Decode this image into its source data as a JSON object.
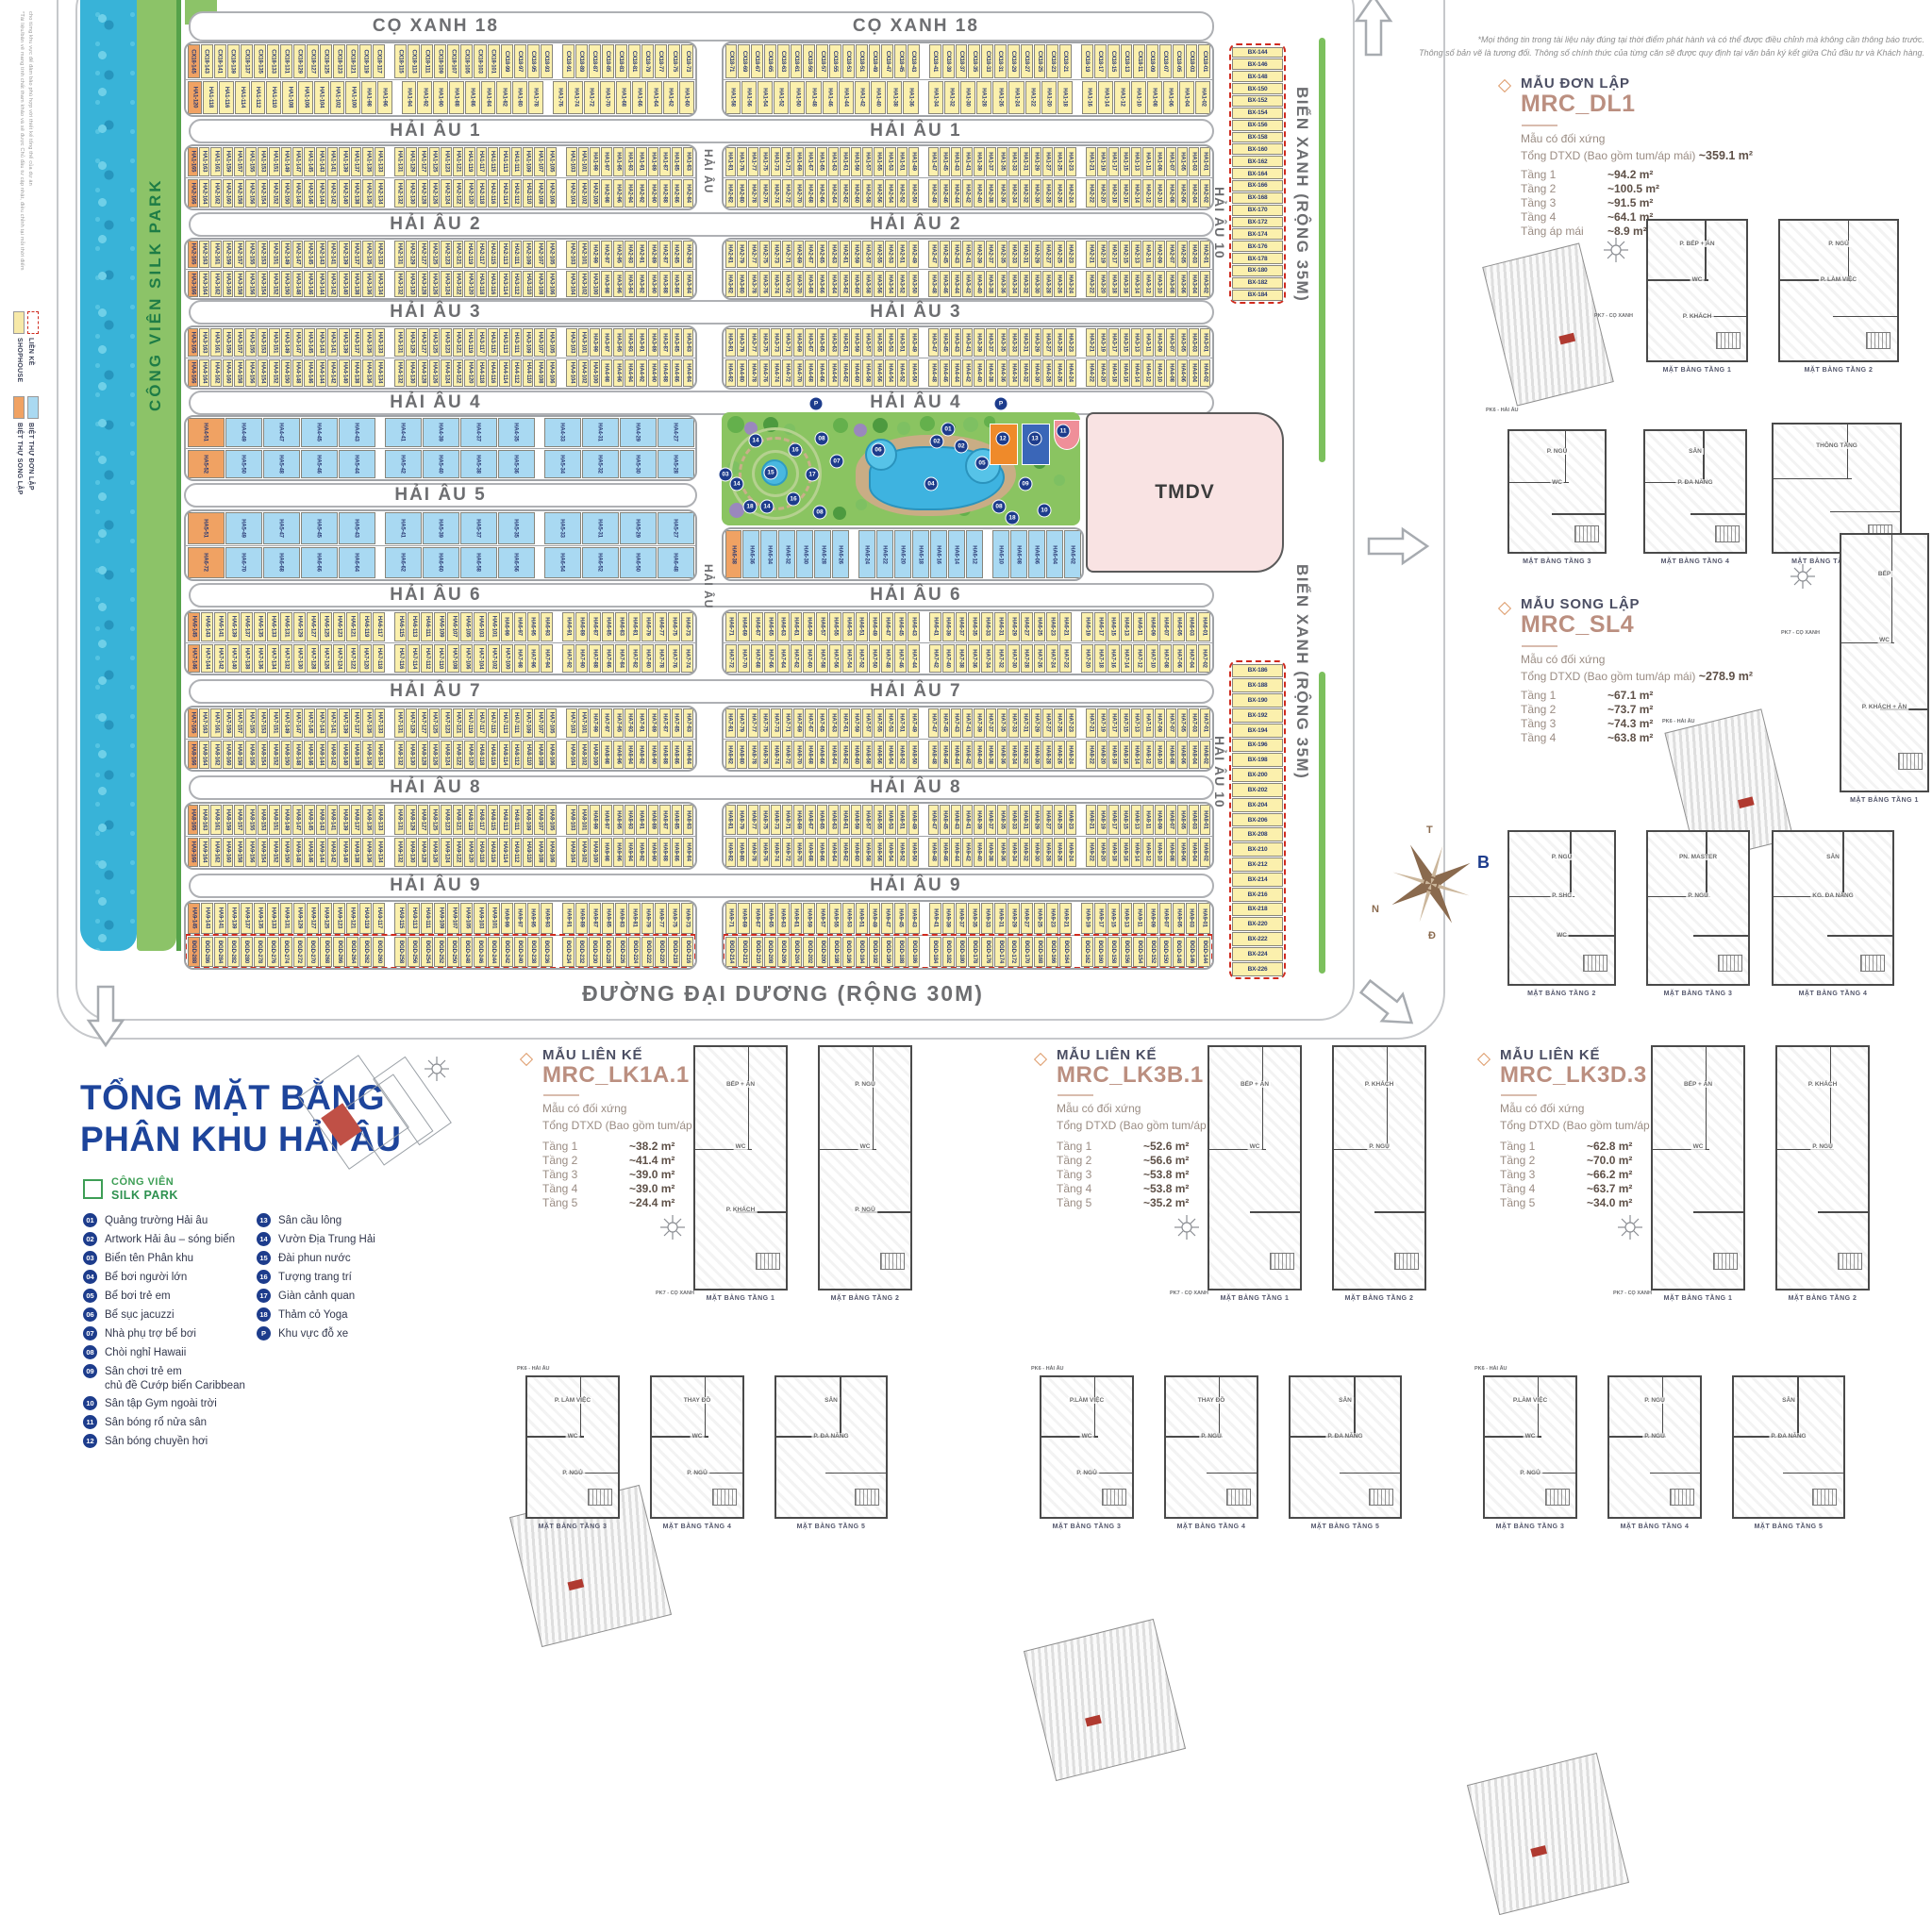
{
  "disclaimers": {
    "top_right_1": "*Mọi thông tin trong tài liệu này đúng tại thời điểm phát hành và có thể được điều chỉnh mà không cần thông báo trước.",
    "top_right_2": "Thông số bản vẽ là tương đối. Thông số chính thức của từng căn sẽ được quy định tại văn bản ký kết giữa Chủ đầu tư và Khách hàng.",
    "left_1": "*Tài liệu/bản vẽ mang tính chất tham khảo và sẽ được Chủ đầu tư cập nhật, điều chỉnh tại mỗi thời điểm",
    "left_2": "cho từng khu vực để đảm bảo phù hợp với thiết kế tổng thể của dự án"
  },
  "park_strip": {
    "line1": "CÔNG VIÊN",
    "line2": "SILK PARK"
  },
  "roads": {
    "mid_vertical": "HẢI ÂU",
    "east_vertical": "HẢI ÂU 10",
    "bien_xanh": "BIỂN XANH (RỘNG 35M)",
    "dai_duong": "ĐƯỜNG ĐẠI DƯƠNG (RỘNG 30M)"
  },
  "tmdv_label": "TMDV",
  "bands": [
    {
      "title": "CỌ XANH 18",
      "top": {
        "prefix": "CX18",
        "from": 145,
        "to": 1,
        "of": true
      },
      "bottom": {
        "prefix": "HA1",
        "from": 120,
        "to": 2,
        "of": true
      }
    },
    {
      "title": "HẢI ÂU 1",
      "top": {
        "prefix": "HA1",
        "from": 165,
        "to": 1,
        "of": true
      },
      "bottom": {
        "prefix": "HA2",
        "from": 166,
        "to": 2,
        "of": true
      }
    },
    {
      "title": "HẢI ÂU 2",
      "top": {
        "prefix": "HA2",
        "from": 165,
        "to": 1,
        "of": true
      },
      "bottom": {
        "prefix": "HA3",
        "from": 166,
        "to": 2,
        "of": true
      }
    },
    {
      "title": "HẢI ÂU 3",
      "top": {
        "prefix": "HA3",
        "from": 165,
        "to": 1,
        "of": true
      },
      "bottom": {
        "prefix": "HA4",
        "from": 166,
        "to": 2,
        "of": true
      }
    },
    {
      "title": "HẢI ÂU 4"
    },
    {
      "title": "HẢI ÂU 6",
      "top": {
        "prefix": "HA6",
        "from": 145,
        "to": 1,
        "of": true
      },
      "bottom": {
        "prefix": "HA7",
        "from": 146,
        "to": 2,
        "of": true
      }
    },
    {
      "title": "HẢI ÂU 7",
      "top": {
        "prefix": "HA7",
        "from": 165,
        "to": 1,
        "of": true
      },
      "bottom": {
        "prefix": "HA8",
        "from": 166,
        "to": 2,
        "of": true
      }
    },
    {
      "title": "HẢI ÂU 8",
      "top": {
        "prefix": "HA8",
        "from": 165,
        "to": 1,
        "of": true
      },
      "bottom": {
        "prefix": "HA9",
        "from": 166,
        "to": 2,
        "of": true
      }
    },
    {
      "title": "HẢI ÂU 9",
      "top": {
        "prefix": "HA9",
        "from": 145,
        "to": 1,
        "of": true
      },
      "bottom": {
        "prefix": "ĐGD",
        "from": 288,
        "to": 144,
        "pad": 3,
        "of": true,
        "dash": true
      }
    }
  ],
  "blue_zone": {
    "title": "HẢI ÂU 5",
    "strip1": {
      "top": {
        "prefix": "HA4",
        "from": 51,
        "to": 27,
        "of": true,
        "blue": true
      },
      "bottom": {
        "prefix": "HA5",
        "from": 52,
        "to": 28,
        "of": true,
        "blue": true
      }
    },
    "strip2": {
      "top": {
        "prefix": "HA5",
        "from": 51,
        "to": 27,
        "of": true,
        "blue": true
      },
      "bottom": {
        "prefix": "HA6",
        "from": 72,
        "to": 48,
        "of": true,
        "blue": true
      }
    },
    "park_row": {
      "prefix": "HA6",
      "from": 38,
      "to": 2,
      "of": true,
      "blue": true
    }
  },
  "bx": {
    "top": {
      "prefix": "BX",
      "from": 144,
      "to": 184,
      "pad": 3
    },
    "bottom": {
      "prefix": "BX",
      "from": 186,
      "to": 226,
      "pad": 3
    }
  },
  "park_markers": [
    "P",
    "P",
    "01",
    "02",
    "02",
    "03",
    "04",
    "05",
    "06",
    "07",
    "08",
    "08",
    "08",
    "09",
    "10",
    "11",
    "12",
    "13",
    "14",
    "14",
    "14",
    "15",
    "16",
    "16",
    "17",
    "18",
    "18"
  ],
  "side_legend": {
    "shophouse": "SHOPHOUSE",
    "lienke": "LIỀN KỀ",
    "songlap": "BIỆT THỰ SONG LẬP",
    "donlap": "BIỆT THỰ ĐƠN LẬP"
  },
  "title_block": {
    "line1": "TỔNG MẶT BẰNG",
    "line2": "PHÂN KHU HẢI ÂU"
  },
  "legend": {
    "park_line1": "CÔNG VIÊN",
    "park_line2": "SILK PARK",
    "col1": [
      {
        "num": "01",
        "label": "Quảng trường Hải âu"
      },
      {
        "num": "02",
        "label": "Artwork Hải âu – sóng biển"
      },
      {
        "num": "03",
        "label": "Biển tên Phân khu"
      },
      {
        "num": "04",
        "label": "Bể bơi người lớn"
      },
      {
        "num": "05",
        "label": "Bể bơi trẻ em"
      },
      {
        "num": "06",
        "label": "Bể sục jacuzzi"
      },
      {
        "num": "07",
        "label": "Nhà phụ trợ bể bơi"
      },
      {
        "num": "08",
        "label": "Chòi nghỉ Hawaii"
      },
      {
        "num": "09",
        "label": "Sân chơi trẻ em",
        "label2": "chủ đề Cướp biển Caribbean"
      },
      {
        "num": "10",
        "label": "Sân tập Gym ngoài trời"
      },
      {
        "num": "11",
        "label": "Sân bóng rổ nửa sân"
      },
      {
        "num": "12",
        "label": "Sân bóng chuyền hơi"
      }
    ],
    "col2": [
      {
        "num": "13",
        "label": "Sân cầu lông"
      },
      {
        "num": "14",
        "label": "Vườn Địa Trung Hải"
      },
      {
        "num": "15",
        "label": "Đài phun nước"
      },
      {
        "num": "16",
        "label": "Tượng trang trí"
      },
      {
        "num": "17",
        "label": "Giàn cảnh quan"
      },
      {
        "num": "18",
        "label": "Thảm cỏ Yoga"
      },
      {
        "num": "P",
        "label": "Khu vực đỗ xe"
      }
    ]
  },
  "compass": {
    "n": "B",
    "e": "Đ",
    "s": "N",
    "w": "T"
  },
  "locator": {
    "pk7": "PK7 - CỌ XANH",
    "pk6": "PK6 - HẢI ÂU"
  },
  "models": [
    {
      "category": "MẪU ĐƠN LẬP",
      "code": "MRC_DL1",
      "sym": "Mẫu có đối xứng",
      "total_label": "Tổng DTXD (Bao gồm tum/áp mái)",
      "total_value": "~359.1 m²",
      "floors": [
        [
          "Tầng 1",
          "~94.2 m²"
        ],
        [
          "Tầng 2",
          "~100.5 m²"
        ],
        [
          "Tầng 3",
          "~91.5 m²"
        ],
        [
          "Tầng 4",
          "~64.1 m²"
        ],
        [
          "Tầng áp mái",
          "~8.9 m²"
        ]
      ],
      "plans": [
        {
          "cap": "MẶT BẰNG TẦNG 1",
          "rooms": [
            "P. BẾP + ĂN",
            "WC",
            "P. KHÁCH"
          ]
        },
        {
          "cap": "MẶT BẰNG TẦNG 2",
          "rooms": [
            "P. NGỦ",
            "P. LÀM VIỆC"
          ]
        },
        {
          "cap": "MẶT BẰNG TẦNG 3",
          "rooms": [
            "P. NGỦ",
            "WC"
          ]
        },
        {
          "cap": "MẶT BẰNG TẦNG 4",
          "rooms": [
            "SÂN",
            "P. ĐA NĂNG"
          ]
        },
        {
          "cap": "MẶT BẰNG TẦNG ÁP MÁI",
          "rooms": [
            "THÔNG TẦNG"
          ]
        }
      ]
    },
    {
      "category": "MẪU SONG LẬP",
      "code": "MRC_SL4",
      "sym": "Mẫu có đối xứng",
      "total_label": "Tổng DTXD (Bao gồm tum/áp mái)",
      "total_value": "~278.9 m²",
      "floors": [
        [
          "Tầng 1",
          "~67.1 m²"
        ],
        [
          "Tầng 2",
          "~73.7 m²"
        ],
        [
          "Tầng 3",
          "~74.3 m²"
        ],
        [
          "Tầng 4",
          "~63.8 m²"
        ]
      ],
      "plans": [
        {
          "cap": "MẶT BẰNG TẦNG 1",
          "rooms": [
            "BẾP",
            "WC",
            "P. KHÁCH + ĂN"
          ]
        },
        {
          "cap": "MẶT BẰNG TẦNG 2",
          "rooms": [
            "P. NGỦ",
            "P. SHC",
            "WC"
          ]
        },
        {
          "cap": "MẶT BẰNG TẦNG 3",
          "rooms": [
            "PN. MASTER",
            "P. NGỦ"
          ]
        },
        {
          "cap": "MẶT BẰNG TẦNG 4",
          "rooms": [
            "SÂN",
            "KG. ĐA NĂNG"
          ]
        }
      ]
    },
    {
      "category": "MẪU LIÊN KẾ",
      "code": "MRC_LK1A.1",
      "sym": "Mẫu có đối xứng",
      "total_label": "Tổng DTXD (Bao gồm tum/áp mái)",
      "total_value": "~182.0 m²",
      "floors": [
        [
          "Tầng 1",
          "~38.2 m²"
        ],
        [
          "Tầng 2",
          "~41.4 m²"
        ],
        [
          "Tầng 3",
          "~39.0 m²"
        ],
        [
          "Tầng 4",
          "~39.0 m²"
        ],
        [
          "Tầng 5",
          "~24.4 m²"
        ]
      ],
      "plans": [
        {
          "cap": "MẶT BẰNG TẦNG 1",
          "rooms": [
            "BẾP + ĂN",
            "WC",
            "P. KHÁCH"
          ]
        },
        {
          "cap": "MẶT BẰNG TẦNG 2",
          "rooms": [
            "P. NGỦ",
            "WC",
            "P. NGỦ"
          ]
        },
        {
          "cap": "MẶT BẰNG TẦNG 3",
          "rooms": [
            "P. LÀM VIỆC",
            "WC",
            "P. NGỦ"
          ]
        },
        {
          "cap": "MẶT BẰNG TẦNG 4",
          "rooms": [
            "THAY ĐỒ",
            "WC",
            "P. NGỦ"
          ]
        },
        {
          "cap": "MẶT BẰNG TẦNG 5",
          "rooms": [
            "SÂN",
            "P. ĐA NĂNG"
          ]
        }
      ]
    },
    {
      "category": "MẪU LIÊN KẾ",
      "code": "MRC_LK3B.1",
      "sym": "Mẫu có đối xứng",
      "total_label": "Tổng DTXD (Bao gồm tum/áp mái)",
      "total_value": "~252.0 m²",
      "floors": [
        [
          "Tầng 1",
          "~52.6 m²"
        ],
        [
          "Tầng 2",
          "~56.6 m²"
        ],
        [
          "Tầng 3",
          "~53.8 m²"
        ],
        [
          "Tầng 4",
          "~53.8 m²"
        ],
        [
          "Tầng 5",
          "~35.2 m²"
        ]
      ],
      "plans": [
        {
          "cap": "MẶT BẰNG TẦNG 1",
          "rooms": [
            "BẾP + ĂN",
            "WC"
          ]
        },
        {
          "cap": "MẶT BẰNG TẦNG 2",
          "rooms": [
            "P. KHÁCH",
            "P. NGỦ"
          ]
        },
        {
          "cap": "MẶT BẰNG TẦNG 3",
          "rooms": [
            "P.LÀM VIỆC",
            "WC",
            "P. NGỦ"
          ]
        },
        {
          "cap": "MẶT BẰNG TẦNG 4",
          "rooms": [
            "THAY ĐỒ",
            "P. NGỦ"
          ]
        },
        {
          "cap": "MẶT BẰNG TẦNG 5",
          "rooms": [
            "SÂN",
            "P. ĐA NĂNG"
          ]
        }
      ]
    },
    {
      "category": "MẪU LIÊN KẾ",
      "code": "MRC_LK3D.3",
      "sym": "Mẫu có đối xứng",
      "total_label": "Tổng DTXD (Bao gồm tum/áp mái)",
      "total_value": "~296.7 m²",
      "floors": [
        [
          "Tầng 1",
          "~62.8 m²"
        ],
        [
          "Tầng 2",
          "~70.0 m²"
        ],
        [
          "Tầng 3",
          "~66.2 m²"
        ],
        [
          "Tầng 4",
          "~63.7 m²"
        ],
        [
          "Tầng 5",
          "~34.0 m²"
        ]
      ],
      "plans": [
        {
          "cap": "MẶT BẰNG TẦNG 1",
          "rooms": [
            "BẾP + ĂN",
            "WC"
          ]
        },
        {
          "cap": "MẶT BẰNG TẦNG 2",
          "rooms": [
            "P. KHÁCH",
            "P. NGỦ"
          ]
        },
        {
          "cap": "MẶT BẰNG TẦNG 3",
          "rooms": [
            "P.LÀM VIỆC",
            "WC",
            "P. NGỦ"
          ]
        },
        {
          "cap": "MẶT BẰNG TẦNG 4",
          "rooms": [
            "P. NGỦ",
            "P. NGỦ"
          ]
        },
        {
          "cap": "MẶT BẰNG TẦNG 5",
          "rooms": [
            "SÂN",
            "P. ĐA NĂNG"
          ]
        }
      ]
    }
  ]
}
